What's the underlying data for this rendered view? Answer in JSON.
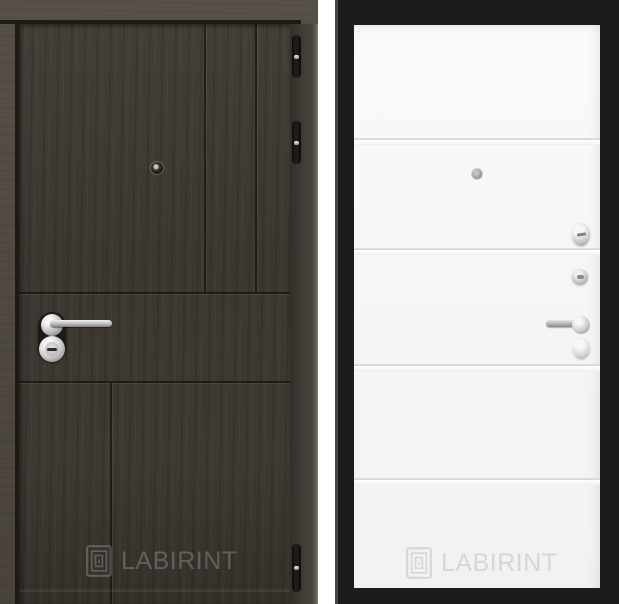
{
  "brand": "LABIRINT",
  "left_photo": {
    "watermark_text": "LABIRINT",
    "leaf_color": "#3e3933",
    "frame_color": "#524c46",
    "groove_color": "#1e1a16",
    "hardware": [
      "peephole-icon",
      "lever-handle",
      "key-cylinder",
      "hinge",
      "hinge",
      "hinge"
    ]
  },
  "right_photo": {
    "watermark_text": "LABIRINT",
    "panel_color": "#f6f6f6",
    "frame_color": "#1d1c1b",
    "hardware": [
      "peephole-icon",
      "thumbturn-knob",
      "key-cylinder",
      "lever-handle",
      "escutcheon"
    ]
  }
}
